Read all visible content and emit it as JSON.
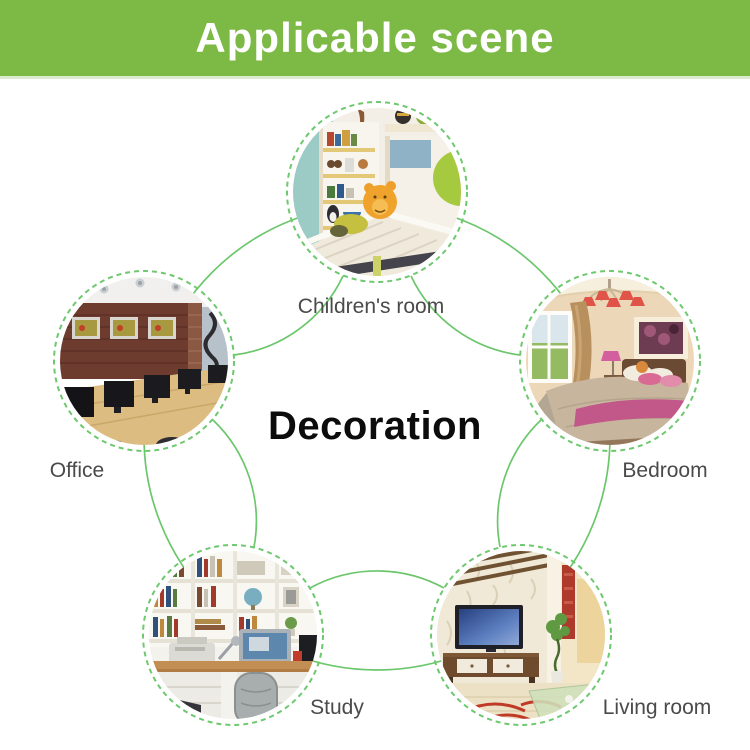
{
  "header": {
    "title": "Applicable scene"
  },
  "diagram": {
    "center_label": "Decoration",
    "nodes": [
      {
        "id": "children-room",
        "label": "Children's room"
      },
      {
        "id": "bedroom",
        "label": "Bedroom"
      },
      {
        "id": "living-room",
        "label": "Living room"
      },
      {
        "id": "study",
        "label": "Study"
      },
      {
        "id": "office",
        "label": "Office"
      }
    ]
  },
  "colors": {
    "banner_background": "#7cb945",
    "banner_text": "#ffffff",
    "connector_green": "#6cc66c",
    "ring_green": "#6ec86e",
    "label_text": "#4a4a4a",
    "center_text": "#0c0c0c",
    "page_background": "#ffffff"
  }
}
